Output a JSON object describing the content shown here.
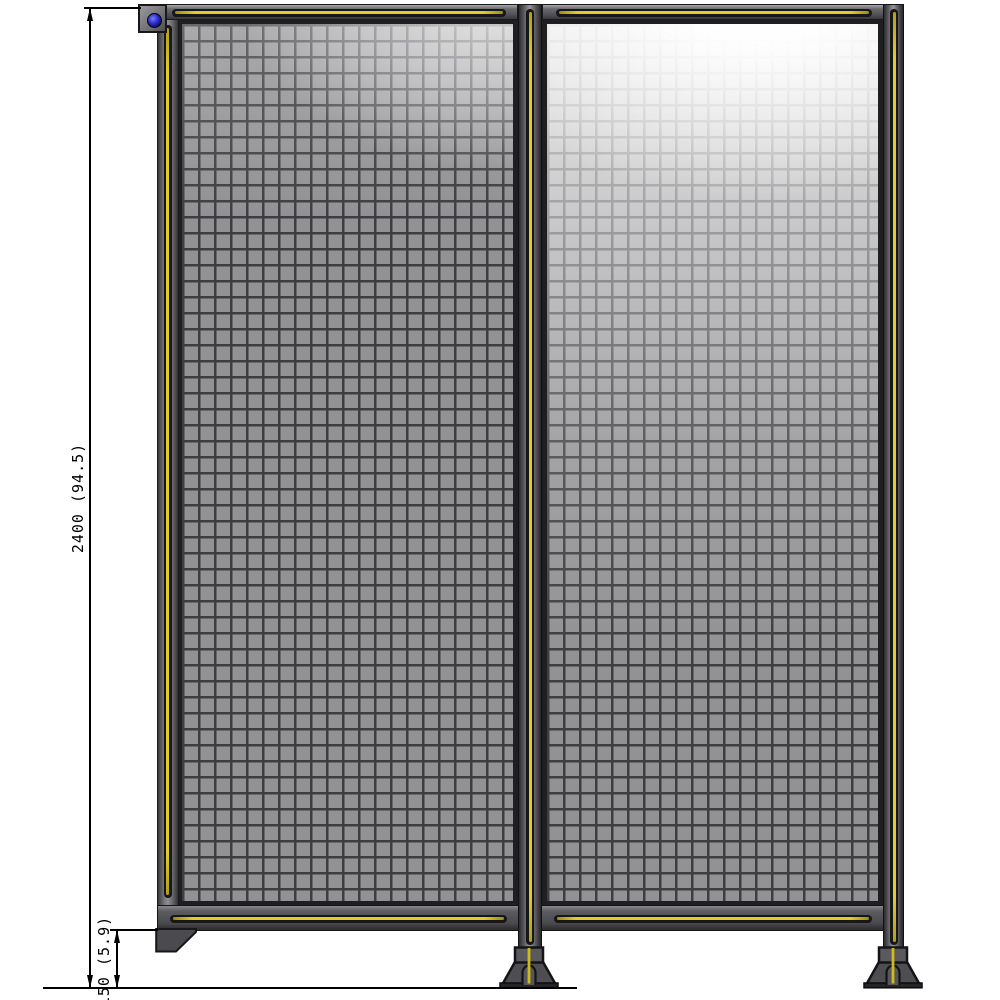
{
  "drawing": {
    "type": "technical-drawing",
    "subject": "Wire mesh partition panels, front elevation with feet and wall bracket",
    "dimension_labels": {
      "overall_height": "2400 (94.5)",
      "base_height": "150 (5.9)"
    },
    "colors": {
      "frame_gray": "#55555a",
      "frame_outline": "#1a1a1c",
      "groove_yellow": "#dfcd28",
      "mesh_fill": "#929295",
      "mesh_wire": "#3e3e41",
      "highlight": "#ffffff",
      "bracket_bolt_blue": "#2a2ac8",
      "foot_gray": "#4e4e52",
      "dimension_line": "#000000"
    },
    "panel_count": 2
  }
}
